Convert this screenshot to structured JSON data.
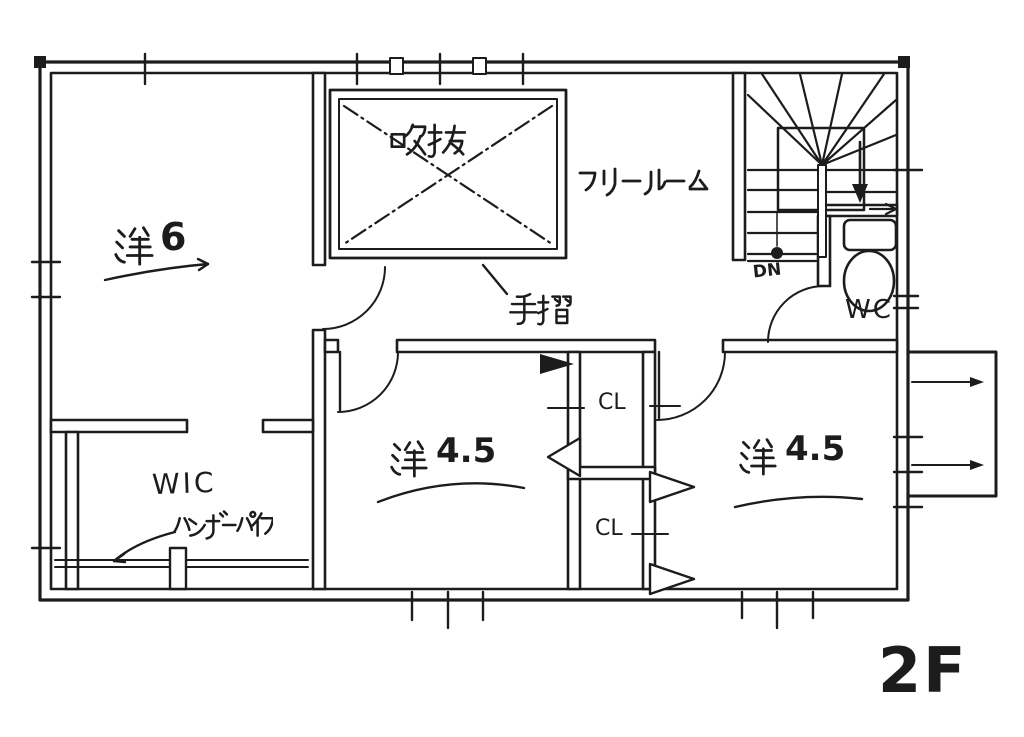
{
  "plan": {
    "floor_label": "2F",
    "rooms": [
      {
        "name": "洋6",
        "type": "洋",
        "size": "6"
      },
      {
        "name": "吹抜"
      },
      {
        "name": "フリールーム"
      },
      {
        "name": "WIC"
      },
      {
        "name": "洋4.5",
        "type": "洋",
        "size": "4.5",
        "position": "center"
      },
      {
        "name": "洋4.5",
        "type": "洋",
        "size": "4.5",
        "position": "right"
      },
      {
        "name": "WC"
      },
      {
        "name": "CL",
        "position": "upper"
      },
      {
        "name": "CL",
        "position": "lower"
      }
    ],
    "annotations": [
      {
        "text": "手摺"
      },
      {
        "text": "ハンガーパイプ"
      },
      {
        "text": "DN"
      }
    ],
    "colors": {
      "ink": "#1c1c1c",
      "paper": "#ffffff"
    }
  }
}
